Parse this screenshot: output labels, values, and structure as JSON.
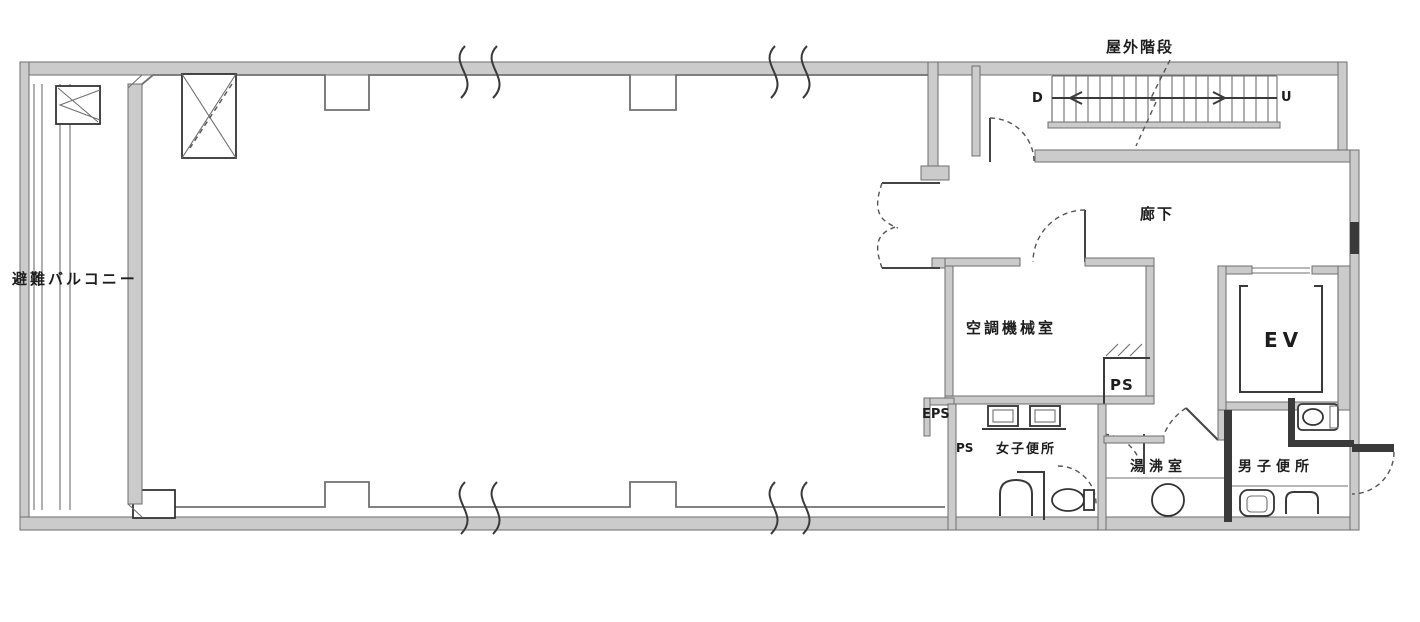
{
  "plan": {
    "labels": {
      "outdoor_stairs": "屋外階段",
      "stair_down": "D",
      "stair_up": "U",
      "corridor": "廊下",
      "machine_room": "空調機械室",
      "ps_machine": "PS",
      "elevator": "EV",
      "eps": "EPS",
      "ps_small": "PS",
      "womens_toilet": "女子便所",
      "kitchenette": "湯沸室",
      "mens_toilet": "男子便所",
      "evac_balcony": "避難バルコニー"
    },
    "colors": {
      "background": "#ffffff",
      "wall_fill": "#cbcbcb",
      "line": "#707070",
      "dark": "#3a3a3a",
      "text": "#1d1d1d"
    }
  }
}
